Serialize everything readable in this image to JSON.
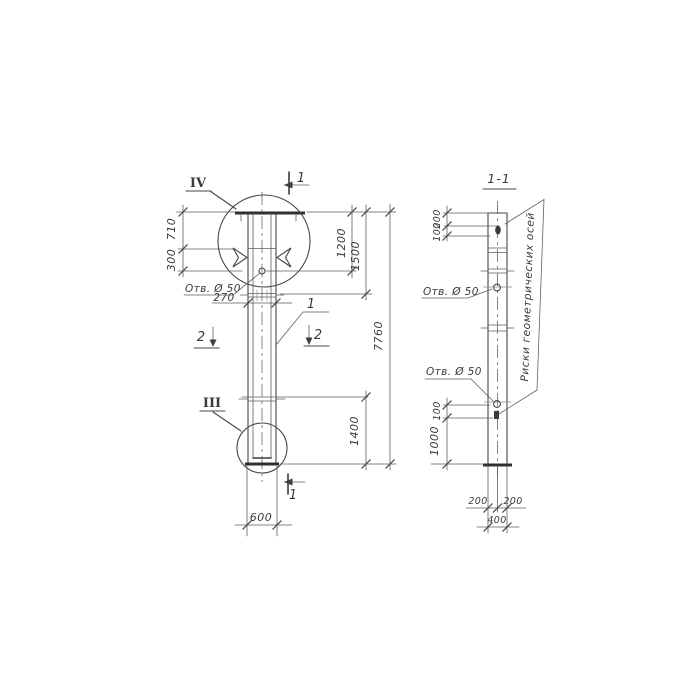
{
  "meta": {
    "ink_color": "#3f3f3f",
    "paper_color": "#ffffff",
    "drawing_type": "column elevation with section"
  },
  "left_view": {
    "detail_top": "IV",
    "detail_bottom": "III",
    "section_top": "1",
    "section_bottom": "1",
    "section_left": "2",
    "section_right": "2",
    "position": "1",
    "hole_label": "Отв. Ø 50",
    "dim_710": "710",
    "dim_300": "300",
    "dim_270": "270",
    "dim_600": "600",
    "dim_1200": "1200",
    "dim_1500": "1500",
    "dim_7760": "7760",
    "dim_1400": "1400"
  },
  "right_view": {
    "title": "1-1",
    "hole_label_upper": "Отв. Ø 50",
    "hole_label_lower": "Отв. Ø 50",
    "axes_note": "Риски геометрических осей",
    "dim_200_top": "200",
    "dim_100_top": "100",
    "dim_100_low": "100",
    "dim_1000": "1000",
    "dim_200_bottom_left": "200",
    "dim_200_bottom_right": "200",
    "dim_400": "400"
  }
}
